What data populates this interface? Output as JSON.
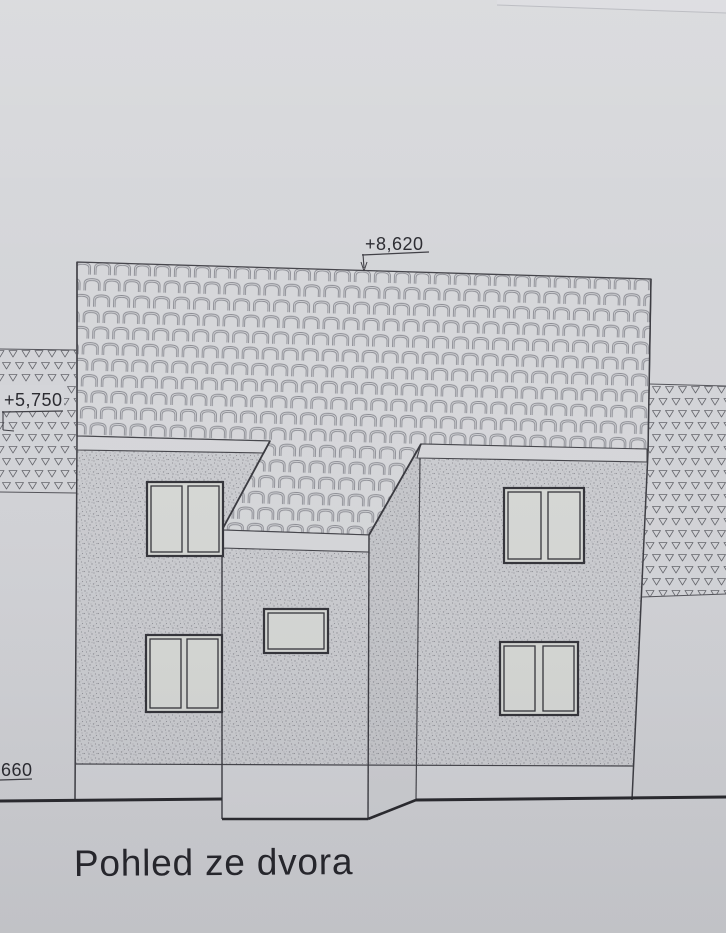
{
  "document": {
    "kind": "architectural elevation drawing",
    "title": "Pohled ze dvora"
  },
  "annotations": {
    "ridge_level_label": "+8,620",
    "left_level_label": "+5,750",
    "base_level_label": "660"
  },
  "colors": {
    "paper": "#d3d4d8",
    "ink": "#46464c",
    "ink_dark": "#2b2b31",
    "wall_fill": "#cbccd0",
    "roof_fill": "#d6d7da",
    "glass_fill": "#d6d8d5",
    "hatch_fill": "#d3d4d8"
  }
}
